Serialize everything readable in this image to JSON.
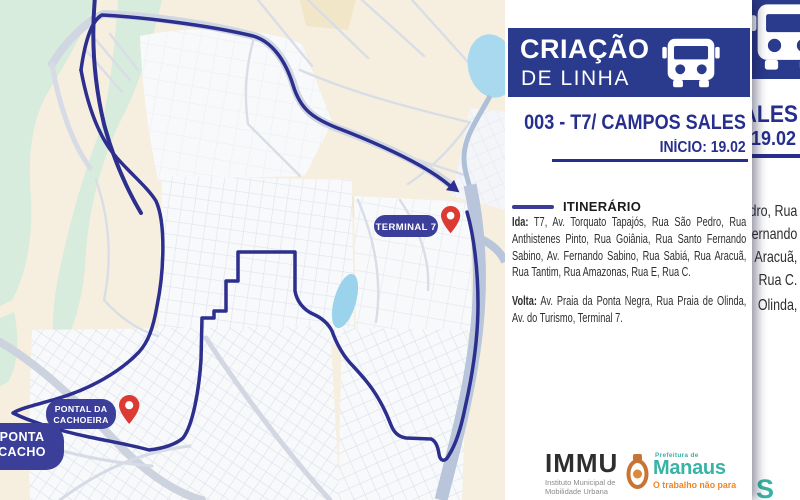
{
  "colors": {
    "banner_navy": "#2a3a8c",
    "route_navy": "#2c2f8d",
    "pill_navy": "#3b3f9a",
    "pin_red": "#db3b33",
    "title_navy": "#272f8e",
    "teal": "#39b3a6",
    "orange": "#ef8524"
  },
  "map": {
    "terminal_label": "TERMINAL 7",
    "pontal_label_line1": "PONTAL DA",
    "pontal_label_line2": "CACHOEIRA",
    "partial_pill_line1": "PONTA",
    "partial_pill_line2": "CACHO"
  },
  "panel": {
    "banner": {
      "title": "CRIAÇÃO",
      "subtitle": "DE LINHA"
    },
    "line_title": "003 - T7/ CAMPOS SALES",
    "line_start": "INÍCIO: 19.02",
    "itinerary": {
      "heading": "ITINERÁRIO",
      "ida_label": "Ida:",
      "ida_lines": [
        "T7, Av. Torquato Tapajós, Rua São Pedro, Rua",
        "Anthistenes Pinto, Rua Goiânia, Rua Santo Fernando",
        "Sabino, Av. Fernando Sabino, Rua Sabiá, Rua Aracuã,",
        "Rua Tantim, Rua Amazonas, Rua E, Rua C."
      ],
      "volta_label": "Volta:",
      "volta_lines": [
        "Av. Praia da Ponta Negra, Rua Praia de Olinda,",
        "Av. do Turismo, Terminal 7."
      ]
    },
    "logos": {
      "immu": {
        "name": "IMMU",
        "subtitle_line1": "Instituto Municipal de",
        "subtitle_line2": "Mobilidade Urbana"
      },
      "manaus": {
        "prefix": "Prefeitura de",
        "name": "Manaus",
        "tagline": "O trabalho não para"
      }
    }
  },
  "background_copy": {
    "title_fragment": "ALES",
    "start_fragment": "19.02",
    "itinerary_fragments": [
      "dro, Rua",
      "ernando",
      "Aracuã,",
      "Rua C.",
      "Olinda,"
    ],
    "logo_fragment": "S"
  }
}
